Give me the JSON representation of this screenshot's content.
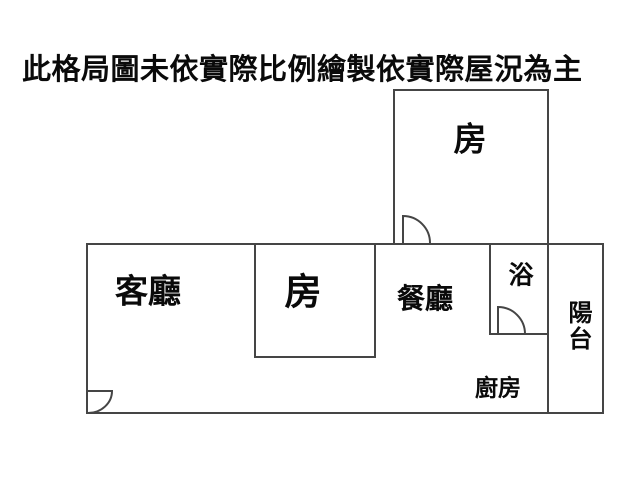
{
  "title": "此格局圖未依實際比例繪製依實際屋況為主",
  "floorplan": {
    "rooms": {
      "bedroom_top": "房",
      "living_room": "客廳",
      "bedroom_middle": "房",
      "dining_room": "餐廳",
      "bathroom": "浴",
      "balcony": "陽台",
      "kitchen": "廚房"
    },
    "colors": {
      "wall": "#454545",
      "text": "#0a0a0a",
      "background": "#ffffff"
    }
  }
}
